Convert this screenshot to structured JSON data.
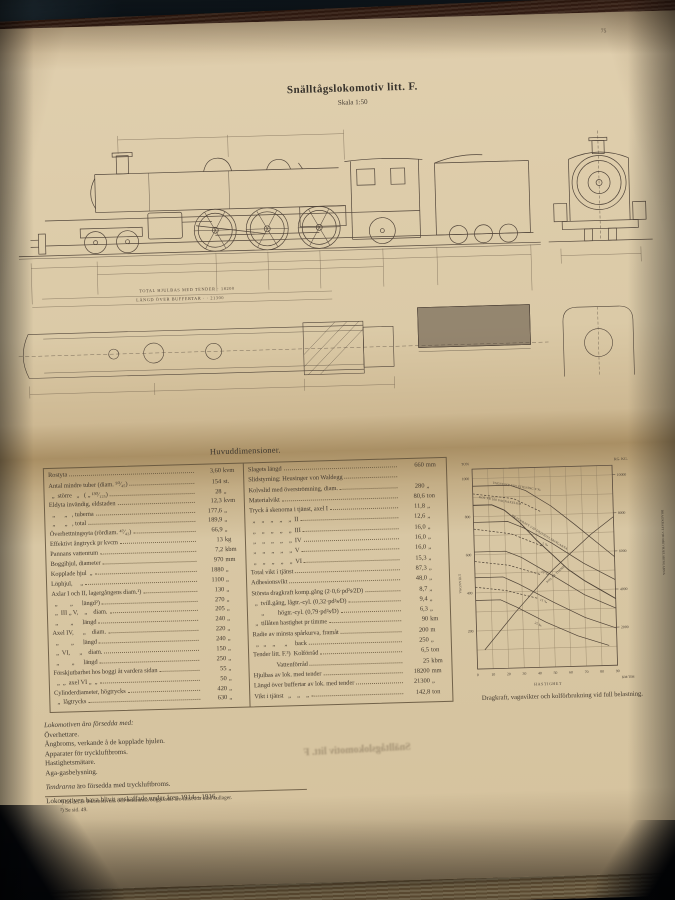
{
  "colors": {
    "page": "#d6c5a2",
    "ink": "#3f3831",
    "background": "#05070c",
    "book_edge": "#7a5138"
  },
  "page": {
    "page_number": "75",
    "title": "Snälltågslokomotiv litt. F.",
    "subtitle": "Skala 1:50",
    "drawing": {
      "dim1": "TOTAL HJULBAS MED TENDER · 18200",
      "dim2": "LÄNGD ÖVER BUFFERTAR ·  ·  21300"
    },
    "section_heading": "Huvuddimensioner.",
    "table": {
      "left_rows": [
        {
          "l": "Rostyta",
          "v": "3,60",
          "u": "kvm"
        },
        {
          "l": "Antal mindre tuber (diam. ⁵⁰⁄₄₅)",
          "v": "154",
          "u": "st."
        },
        {
          "l": "  „  större   „   ( „ ¹³⁰⁄₁₂₅)",
          "v": "28",
          "u": "„"
        },
        {
          "l": "Eldyta invändig, eldstaden",
          "v": "12,3",
          "u": "kvm"
        },
        {
          "l": "  „      „   , tuberna",
          "v": "177,6",
          "u": "„"
        },
        {
          "l": "  „      „   , total",
          "v": "189,9",
          "u": "„"
        },
        {
          "l": "Överhettningsyta (rördiam. ⁴⁷⁄₄₂)",
          "v": "66,9",
          "u": "„"
        },
        {
          "l": "Effektivt ångtryck pr kvcm",
          "v": "13",
          "u": "kg"
        },
        {
          "l": "Pannans vattenrum",
          "v": "7,2",
          "u": "kbm"
        },
        {
          "l": "Boggihjul, diameter",
          "v": "970",
          "u": "mm"
        },
        {
          "l": "Kopplade hjul  „",
          "v": "1880",
          "u": "„"
        },
        {
          "l": "Löphjul,     „",
          "v": "1100",
          "u": "„"
        },
        {
          "l": "Axlar I och II, lagergångens diam.¹)",
          "v": "130",
          "u": "„"
        },
        {
          "l": "  „        „      längd²)",
          "v": "270",
          "u": "„"
        },
        {
          "l": "  „  III „ V,    „    diam.",
          "v": "205",
          "u": "„"
        },
        {
          "l": "  „        „      längd",
          "v": "240",
          "u": "„"
        },
        {
          "l": "Axel IV,      „    diam.",
          "v": "220",
          "u": "„"
        },
        {
          "l": "  „        „      längd",
          "v": "240",
          "u": "„"
        },
        {
          "l": "  „  VI,      „    diam.",
          "v": "150",
          "u": "„"
        },
        {
          "l": "  „        „      längd",
          "v": "250",
          "u": "„"
        },
        {
          "l": "Förskjutbarhet hos boggi åt vardera sidan",
          "v": "55",
          "u": "„"
        },
        {
          "l": "  „  „  axel VI „  „",
          "v": "50",
          "u": "„"
        },
        {
          "l": "Cylinderdiameter, högtrycks",
          "v": "420",
          "u": "„"
        },
        {
          "l": "  „  lågtrycks",
          "v": "630",
          "u": "„"
        }
      ],
      "right_rows": [
        {
          "l": "Slagets längd",
          "v": "660",
          "u": "mm"
        },
        {
          "l": "Slidstyrning: Heusinger von Waldegg",
          "v": "",
          "u": ""
        },
        {
          "l": "Kolvslid med överströmning, diam.",
          "v": "280",
          "u": "„"
        },
        {
          "l": "Materialvikt",
          "v": "80,6",
          "u": "ton"
        },
        {
          "l": "Tryck å skenorna i tjänst, axel I",
          "v": "11,8",
          "u": "„"
        },
        {
          "l": "  „    „    „    „    „  II",
          "v": "12,6",
          "u": "„"
        },
        {
          "l": "  „    „    „    „    „  III",
          "v": "16,0",
          "u": "„"
        },
        {
          "l": "  „    „    „    „    „  IV",
          "v": "16,0",
          "u": "„"
        },
        {
          "l": "  „    „    „    „    „  V",
          "v": "16,0",
          "u": "„"
        },
        {
          "l": "  „    „    „    „    „  VI",
          "v": "15,3",
          "u": "„"
        },
        {
          "l": "Total vikt i tjänst",
          "v": "87,3",
          "u": "„"
        },
        {
          "l": "Adhesionsvikt",
          "v": "48,0",
          "u": "„"
        },
        {
          "l": "Största dragkraft komp.gång (2·0,6·pd²s⁄2D)",
          "v": "8,7",
          "u": "„"
        },
        {
          "l": "  „  tvill.gång, lågtr.-cyl. (0,32·pd²s⁄D)",
          "v": "9,4",
          "u": "„"
        },
        {
          "l": "      „         högtr.-cyl. (0,79·pd²s⁄D)",
          "v": "6,3",
          "u": "„"
        },
        {
          "l": "  „  tillåten hastighet pr timme",
          "v": "90",
          "u": "km"
        },
        {
          "l": "Radie av minsta spårkurva, framåt",
          "v": "200",
          "u": "m"
        },
        {
          "l": "  „   „    „      „     back",
          "v": "250",
          "u": "„"
        },
        {
          "l": "Tender litt. F.³)  Kolförråd",
          "v": "6,5",
          "u": "ton"
        },
        {
          "l": "               Vattenförråd",
          "v": "25",
          "u": "kbm"
        },
        {
          "l": "Hjulbas av lok. med tender",
          "v": "18200",
          "u": "mm"
        },
        {
          "l": "Längd över buffertar av lok. med tender",
          "v": "21300",
          "u": "„"
        },
        {
          "l": "Vikt i tjänst   „    „    „",
          "v": "142,8",
          "u": "ton"
        }
      ]
    },
    "chart_caption": "Dragkraft, vagnvikter och kolförbrukning vid full belastning.",
    "equipment": {
      "intro": "Lokomotiven äro försedda med:",
      "items": [
        "Överhettare.",
        "Ångbroms, verkande å de kopplade hjulen.",
        "Apparater för tryckluftbroms.",
        "Hastighetsmätare.",
        "Aga-gasbelysning."
      ],
      "tender_word": "Tendrarna",
      "tender_rest": " äro försedda med tryckluftbroms.",
      "acquired_line": "Lokomotiven hava blivit anskaffade under åren 1914—1916."
    },
    "footnotes": [
      "¹) En del av lokomotivens och tendrarnas boggiaxlar äro försedda med kullager.",
      "²) Se sid. 49."
    ],
    "bleedthrough_text": "Snälltågslokomotiv litt. F"
  },
  "chart_data": {
    "type": "line",
    "title": "Dragkraft, vagnvikter och kolförbrukning vid full belastning.",
    "xlabel": "HASTIGHET",
    "x_unit": "KM/TIM",
    "x_max": 90,
    "x_ticks": [
      0,
      10,
      20,
      30,
      40,
      50,
      60,
      70,
      80,
      90
    ],
    "grid": true,
    "left_axis": {
      "label": "VAGNVIKT",
      "unit": "TON",
      "max": 1050,
      "ticks": [
        200,
        400,
        600,
        800,
        1000
      ]
    },
    "right_axis": {
      "label": "DRAGKRAFT VID DRIVHJULSRINGARNA",
      "unit": "KG.  KG.",
      "max": 10500,
      "ticks": [
        2000,
        4000,
        6000,
        8000,
        10000
      ]
    },
    "series": [
      {
        "name": "Vagnvikt vid stigning 0 promille",
        "axis": "left",
        "style": "solid",
        "points": [
          [
            0,
            960
          ],
          [
            24,
            960
          ],
          [
            34,
            930
          ],
          [
            50,
            845
          ],
          [
            65,
            745
          ],
          [
            80,
            640
          ],
          [
            90,
            570
          ]
        ],
        "label": {
          "text": "VAGNVIKT VID STIGNING 0 ‰",
          "lx": 40,
          "ly": 31,
          "rot": 10
        }
      },
      {
        "name": "Vagnvikt vid stigning 5 promille",
        "axis": "left",
        "style": "solid",
        "points": [
          [
            0,
            770
          ],
          [
            22,
            770
          ],
          [
            32,
            735
          ],
          [
            50,
            650
          ],
          [
            70,
            540
          ],
          [
            90,
            450
          ]
        ],
        "label": {
          "text": "5 ‰",
          "lx": 88,
          "ly": 93,
          "rot": 20
        }
      },
      {
        "name": "Vagnvikt vid stigning 10 promille",
        "axis": "left",
        "style": "solid",
        "points": [
          [
            0,
            615
          ],
          [
            20,
            615
          ],
          [
            30,
            580
          ],
          [
            50,
            480
          ],
          [
            70,
            375
          ],
          [
            90,
            300
          ]
        ],
        "label": {
          "text": "10 ‰",
          "lx": 86,
          "ly": 121,
          "rot": 24
        }
      },
      {
        "name": "Vagnvikt vid stigning 15 promille",
        "axis": "left",
        "style": "solid",
        "points": [
          [
            0,
            480
          ],
          [
            18,
            480
          ],
          [
            28,
            440
          ],
          [
            50,
            340
          ],
          [
            70,
            255
          ],
          [
            90,
            195
          ]
        ],
        "label": {
          "text": "15 ‰",
          "lx": 84,
          "ly": 149,
          "rot": 24
        }
      },
      {
        "name": "Vagnvikt vid stigning 25 promille",
        "axis": "left",
        "style": "solid",
        "points": [
          [
            0,
            360
          ],
          [
            16,
            360
          ],
          [
            26,
            320
          ],
          [
            45,
            235
          ],
          [
            65,
            160
          ],
          [
            85,
            105
          ]
        ],
        "label": {
          "text": "25 ‰",
          "lx": 78,
          "ly": 172,
          "rot": 26
        }
      },
      {
        "name": "Dragkraft vid drivhjulsringarna",
        "axis": "right",
        "style": "solid",
        "width": 0.95,
        "points": [
          [
            0,
            8600
          ],
          [
            12,
            8600
          ],
          [
            20,
            8300
          ],
          [
            30,
            7600
          ],
          [
            40,
            6700
          ],
          [
            50,
            5900
          ],
          [
            60,
            5100
          ],
          [
            70,
            4500
          ],
          [
            80,
            4000
          ],
          [
            90,
            3500
          ]
        ],
        "label": {
          "text": "DRAGKRAFT VID DRIVHJULSRINGARNA",
          "lx": 58,
          "ly": 64,
          "rot": 33
        }
      },
      {
        "name": "Kol pr timme",
        "axis": "right",
        "style": "solid",
        "points": [
          [
            5,
            1000
          ],
          [
            25,
            2900
          ],
          [
            50,
            5100
          ],
          [
            75,
            6900
          ],
          [
            90,
            7800
          ]
        ],
        "label": {
          "text": "KOL PR TIMME",
          "lx": 92,
          "ly": 132,
          "rot": -41
        }
      },
      {
        "name": "Kolförbrukning 0 promille",
        "axis": "left",
        "style": "dashed",
        "points": [
          [
            0,
            920
          ],
          [
            26,
            890
          ],
          [
            44,
            815
          ]
        ],
        "label": {
          "text": "KOL PR 100 VAGNAXELKM",
          "lx": 26,
          "ly": 45,
          "rot": 11
        }
      },
      {
        "name": "Kolförbrukning 5 promille",
        "axis": "left",
        "style": "dashed",
        "points": [
          [
            0,
            735
          ],
          [
            24,
            705
          ],
          [
            44,
            635
          ]
        ]
      },
      {
        "name": "Kolförbrukning 10 promille",
        "axis": "left",
        "style": "dashed",
        "points": [
          [
            0,
            565
          ],
          [
            22,
            540
          ],
          [
            42,
            487
          ]
        ]
      },
      {
        "name": "Kolförbrukning 15 promille",
        "axis": "left",
        "style": "dashed",
        "points": [
          [
            0,
            430
          ],
          [
            20,
            408
          ],
          [
            40,
            362
          ]
        ]
      }
    ]
  }
}
